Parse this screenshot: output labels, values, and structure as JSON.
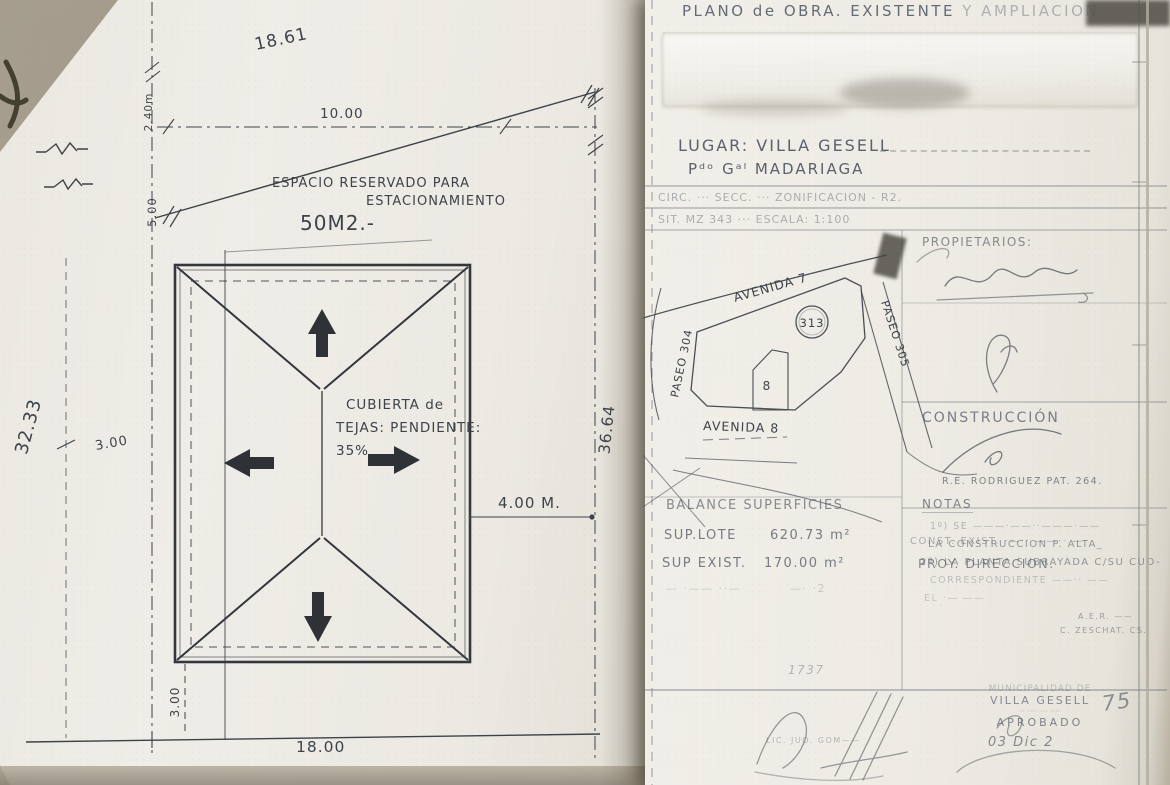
{
  "page": {
    "left": {
      "dims": {
        "top": "18.61",
        "top_inner": "10.00",
        "left_small": "2.40m",
        "left_small2": "5.00",
        "left_depth": "32.33",
        "left_offset": "3.00",
        "right_depth": "36.64",
        "side_setback": "4.00 M.",
        "bottom_setback": "3.00",
        "bottom_width": "18.00"
      },
      "parking": {
        "line1": "ESPACIO RESERVADO PARA",
        "line2": "ESTACIONAMIENTO",
        "area": "50M2.-"
      },
      "roof": {
        "line1": "CUBIERTA de",
        "line2": "TEJAS: PENDIENTE:",
        "line3": "35%"
      }
    },
    "right": {
      "title": {
        "main": "PLANO de OBRA. EXISTENTE",
        "rest": "Y AMPLIACION"
      },
      "location": {
        "lugar": "LUGAR: VILLA GESELL",
        "partido": "Pᵈᵒ Gᵃˡ MADARIAGA",
        "row1": "CIRC. ··· SECC. ··· ZONIFICACION - R2.",
        "row2": "SIT.        MZ 343 ···  ESCALA: 1:100"
      },
      "map": {
        "street_top": "AVENIDA 7",
        "street_bottom": "AVENIDA 8",
        "street_left": "PASEO 304",
        "street_right": "PASEO 305",
        "block_number": "313",
        "lot_number": "8"
      },
      "owners": {
        "label": "PROPIETARIOS:",
        "const_exist": "CONST. EXIST. ·—·· ——·· —·",
        "proy": "PROY. DIRECCION.",
        "cred1": "A.E.R. ——",
        "cred2": "C. ZESCHAT. CS."
      },
      "construction": {
        "label": "CONSTRUCCIÓN",
        "builder": "R.E. RODRIGUEZ PAT. 264."
      },
      "balance": {
        "title": "BALANCE SUPERFICIES",
        "rows": [
          {
            "label": "SUP.LOTE",
            "value": "620.73 m²"
          },
          {
            "label": "SUP EXIST.",
            "value": "170.00 m²"
          },
          {
            "label": "— ·—— ··—",
            "value": "—· ·2"
          }
        ]
      },
      "notes": {
        "title": "NOTAS",
        "lines": [
          "1º) SE ———·——··———·——",
          "LA CONSTRUCCION  P. ALTA_",
          "2º) LA PLANTA SUBRAYADA C/SU CUO-",
          "CORRESPONDIENTE ——·· ——",
          "EL ·— ——"
        ]
      },
      "approval": {
        "number": "1737",
        "stamp": [
          "MUNICIPALIDAD DE",
          "VILLA GESELL",
          "·· ···· ··· ····",
          "APROBADO"
        ],
        "date": "03 Dic 2",
        "year": "75",
        "sig_caption": "LIC. JUO. GOM——"
      }
    }
  }
}
